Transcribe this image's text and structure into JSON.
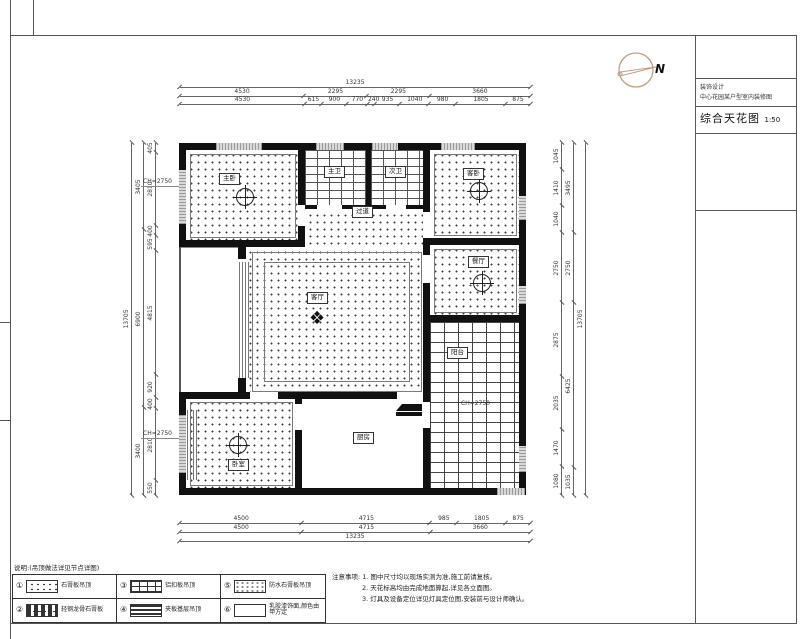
{
  "title_block": {
    "firm_line1": "装饰设计",
    "firm_line2": "中心花园某户型室内装修图",
    "drawing_name": "综合天花图",
    "scale": "1:50"
  },
  "north": {
    "label": "N"
  },
  "dims": {
    "top": {
      "total": [
        "13235"
      ],
      "row2": [
        "4530",
        "2295",
        "2295",
        "3660"
      ],
      "row3": [
        "4530",
        "615",
        "900",
        "770",
        "240",
        "935",
        "1040",
        "980",
        "1805",
        "875"
      ]
    },
    "bottom": {
      "row1": [
        "4500",
        "4715",
        "985",
        "1805",
        "875"
      ],
      "row2": [
        "4500",
        "4715",
        "3660"
      ],
      "total": [
        "13235"
      ]
    },
    "left": {
      "total": [
        "13705"
      ],
      "middle": [
        "3405",
        "6900",
        "3400"
      ],
      "inner": [
        "405",
        "2810",
        "400",
        "595",
        "4815",
        "920",
        "400",
        "2810",
        "550"
      ]
    },
    "right": {
      "inner": [
        "1045",
        "1410",
        "1040",
        "2750",
        "2875",
        "2035",
        "1470",
        "1080"
      ],
      "middle": [
        "3495",
        "2750",
        "6425",
        "1035"
      ],
      "total": [
        "13705"
      ]
    }
  },
  "rooms": {
    "master_bedroom": {
      "label": "主卧"
    },
    "bath1": {
      "label": "主卫"
    },
    "bath2": {
      "label": "次卫"
    },
    "hallway": {
      "label": "过道"
    },
    "bedroom2": {
      "label": "客卧"
    },
    "dining": {
      "label": "餐厅"
    },
    "living": {
      "label": "客厅"
    },
    "bedroom3": {
      "label": "卧室"
    },
    "kitchen": {
      "label": "厨房"
    },
    "balcony": {
      "label": "阳台"
    }
  },
  "annos": {
    "left_top": "CH=2750",
    "left_bottom": "CH=2750",
    "balcony": "CH=2750"
  },
  "legend": {
    "header": "说明:(吊顶做法详见节点详图)",
    "items": [
      {
        "num": "①",
        "label": "石膏板吊顶"
      },
      {
        "num": "②",
        "label": "轻钢龙骨石膏板"
      },
      {
        "num": "③",
        "label": "铝扣板吊顶"
      },
      {
        "num": "④",
        "label": "夹板基层吊顶"
      },
      {
        "num": "⑤",
        "label": "防水石膏板吊顶"
      },
      {
        "num": "⑥",
        "label": "乳胶漆饰面,颜色由甲方定"
      }
    ]
  },
  "notes": {
    "title": "注意事项:",
    "lines": [
      "1. 图中尺寸均以现场实测为准,施工前请复核。",
      "2. 天花标高均由完成地面算起,详见各立面图。",
      "3. 灯具及设备定位详见灯具定位图,安装前与设计师确认。"
    ]
  },
  "colors": {
    "wall": "#111111",
    "north_arrow": "#c49a82",
    "line": "#666666"
  }
}
